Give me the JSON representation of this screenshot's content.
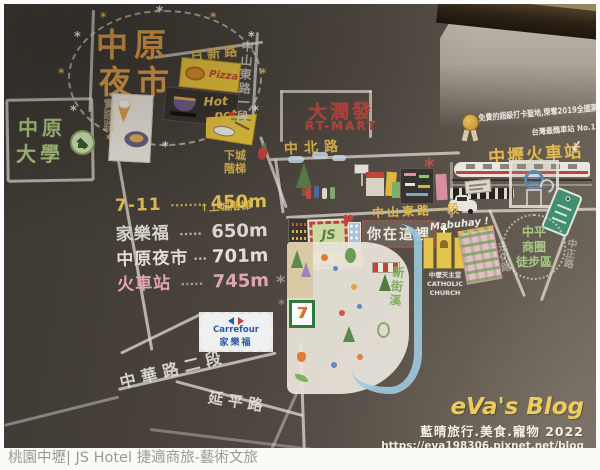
{
  "photo": {
    "night_market": {
      "line1": "中原",
      "line2": "夜市"
    },
    "university": {
      "line1": "中原",
      "line2": "大學"
    },
    "roads": {
      "rixin": "日新路",
      "zhongshan_vertical": "中山東路一段",
      "shijian": "實踐路",
      "zhongbei": "中北路",
      "zhongshan_horizontal": "中山東路一段",
      "zhonghua": "中華路二段",
      "yanping": "延平路",
      "yuanhua": "元化路",
      "zhongzheng": "中正路"
    },
    "stairs": {
      "down": "下城階梯",
      "up": "↑上城階梯"
    },
    "food": {
      "pizza": "Pizza",
      "hot": "Hot",
      "pot": "pot"
    },
    "distance_list": [
      {
        "label": "7-11",
        "dots": "·······",
        "value": "450m",
        "color": "#e5c258"
      },
      {
        "label": "家樂福",
        "dots": "·····",
        "value": "650m",
        "color": "#dcd7cc"
      },
      {
        "label": "中原夜市",
        "dots": "···",
        "value": "701m",
        "color": "#e6dada"
      },
      {
        "label": "火車站",
        "dots": "·····",
        "value": "745m",
        "color": "#e2a4b2"
      }
    ],
    "rt_mart": {
      "zh": "大潤發",
      "en": "RT-MART"
    },
    "station": {
      "name": "中壢火車站",
      "note1": "免費的超級打卡聖地,榮奪2019全國票選",
      "note2": "台灣最醜車站 No.1"
    },
    "hotel": {
      "sign_line1": "JS",
      "sign_line2": "HOTEL",
      "you_are_here": "你在這裡"
    },
    "church": {
      "greeting": "Mabuhay !",
      "name_zh": "中壢天主堂",
      "name_en": "CATHOLIC CHURCH"
    },
    "district": {
      "line1": "中平",
      "line2": "商圈",
      "line3": "徒步區"
    },
    "river": "新街溪",
    "seven_eleven_logo": "7",
    "carrefour": {
      "en": "Carrefour",
      "zh": "家樂福"
    },
    "watermark": {
      "title": "eVa's Blog",
      "subtitle": "藍晴旅行.美食.寵物 2022",
      "url": "https://eva198306.pixnet.net/blog"
    }
  },
  "caption": "桃園中壢| JS Hotel 捷適商旅-藝術文旅",
  "colors": {
    "board": "#4c463f",
    "chalk_white": "#e6e2d8",
    "chalk_yellow": "#d9b34a",
    "chalk_orange": "#e0a04a",
    "chalk_red": "#c0443a",
    "chalk_green": "#9cc37c",
    "chalk_pink": "#e2a4b2",
    "chalk_blue": "#9cc8dd",
    "carrefour_blue": "#2b5aa6"
  }
}
